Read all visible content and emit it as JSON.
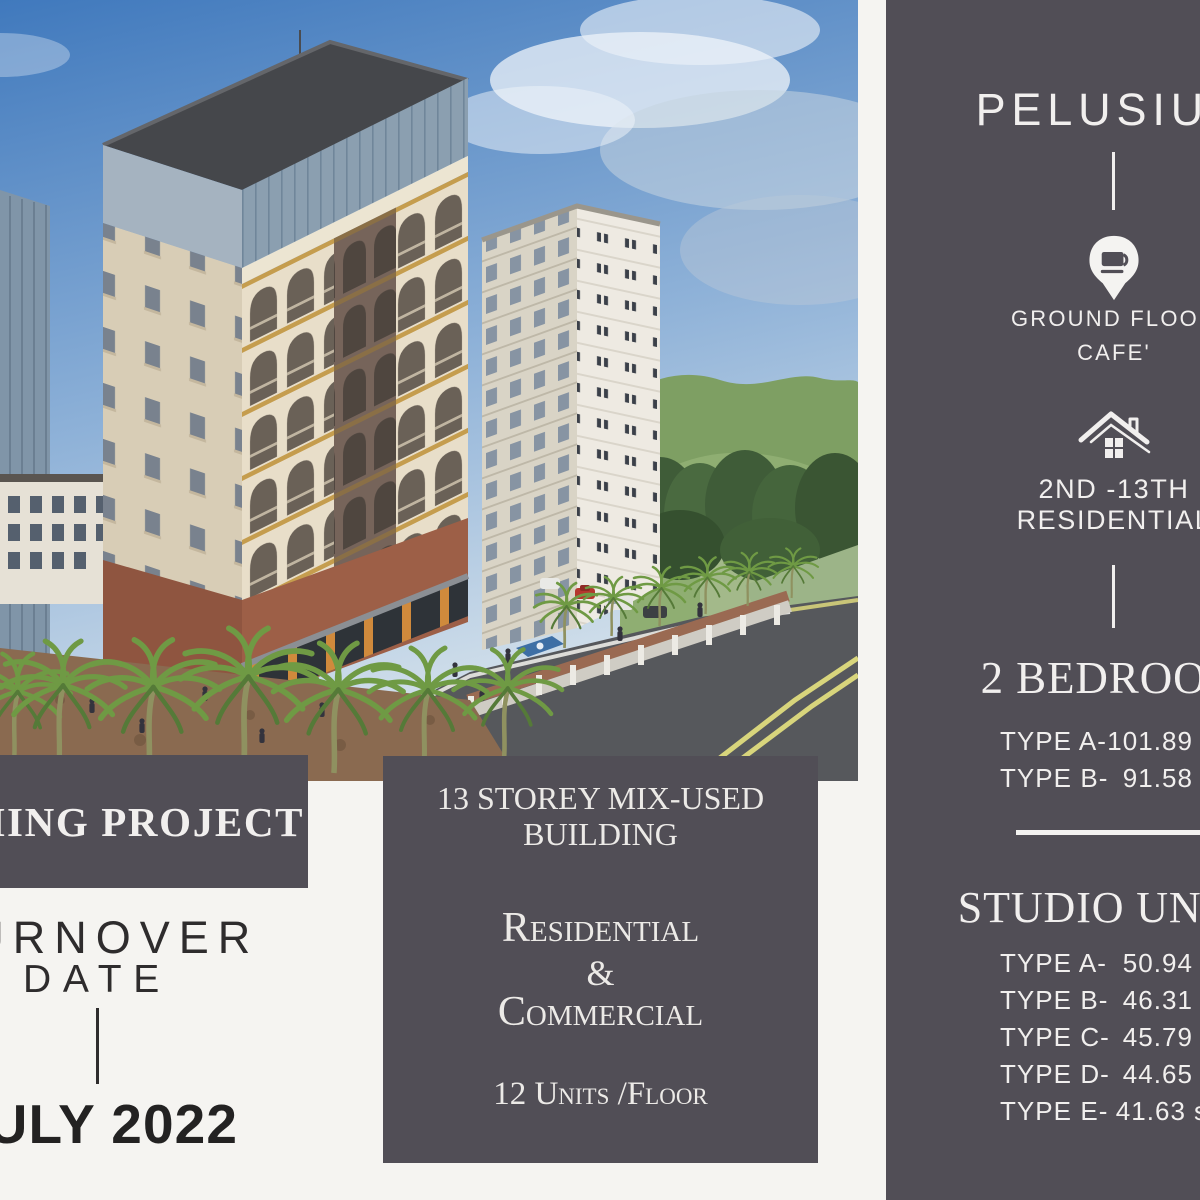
{
  "colors": {
    "page_bg": "#f5f4f1",
    "panel_bg": "#514e56",
    "panel_text": "#f1efee",
    "dark_text": "#2e2c2d"
  },
  "photo": {
    "alt": "Aerial 3D render of a 13-storey cream building with arched balconies, second residential tower, palm-lined street, road and green mountains"
  },
  "upcoming_box": {
    "label": "UPCOMING PROJECT"
  },
  "turnover": {
    "line1": "TURNOVER",
    "line2": "DATE",
    "date": "JULY 2022"
  },
  "info_box": {
    "line1": "13 STOREY MIX-USED",
    "line2": "BUILDING",
    "line3": "Residential",
    "amp": "&",
    "line4": "Commercial",
    "units_per_floor": "12 Units /Floor"
  },
  "panel": {
    "title": "PELUSIUM",
    "ground_floor": {
      "line1": "GROUND FLOOR",
      "line2": "CAFE'"
    },
    "floors": {
      "line1": "2ND -13TH",
      "line2": "RESIDENTIAL"
    },
    "two_bedroom": {
      "heading": "2 BEDROOM",
      "rows": [
        {
          "label": "TYPE A-",
          "value": "101.89",
          "unit": "sqm"
        },
        {
          "label": "TYPE B-",
          "value": "91.58",
          "unit": "sqm"
        }
      ]
    },
    "studio": {
      "heading": "STUDIO UNITS",
      "rows": [
        {
          "label": "TYPE A-",
          "value": "50.94",
          "unit": "sqm"
        },
        {
          "label": "TYPE B-",
          "value": "46.31",
          "unit": "sqm"
        },
        {
          "label": "TYPE C-",
          "value": "45.79",
          "unit": "sqm"
        },
        {
          "label": "TYPE D-",
          "value": "44.65",
          "unit": "sqm"
        },
        {
          "label": "TYPE E-",
          "value": "41.63",
          "unit": "sqm"
        }
      ]
    }
  }
}
